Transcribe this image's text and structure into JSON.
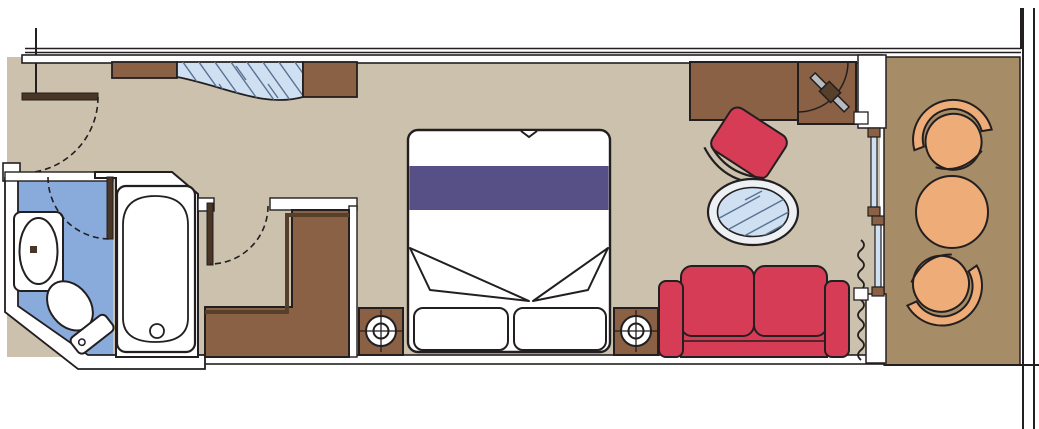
{
  "plan": {
    "scene": "cruise-ship-cabin-floor-plan",
    "areas": [
      "entry",
      "bathroom",
      "dressing-nook",
      "bedroom",
      "sitting-area",
      "balcony"
    ],
    "furniture": [
      "entry-door",
      "mirrored-closet",
      "bathroom-sink",
      "toilet",
      "bathtub",
      "bathroom-door",
      "dressing-door",
      "wardrobe",
      "nightstand-left",
      "double-bed",
      "nightstand-right",
      "desk",
      "desk-chair",
      "tv-cabinet",
      "glass-oval-table",
      "sofa",
      "curtain",
      "sliding-balcony-door",
      "balcony-armchair-top",
      "balcony-round-table",
      "balcony-armchair-bottom",
      "balcony-railing"
    ]
  },
  "colors": {
    "background": "#ffffff",
    "outline": "#231f20",
    "wall_fill": "#ffffff",
    "room_floor": "#cbc1ac",
    "balcony_floor": "#a78c68",
    "furniture_brown": "#8a6144",
    "furniture_brown_dark": "#56402c",
    "door_leaf_brown": "#4a3627",
    "accent_red": "#d63c55",
    "bed_runner_purple": "#565086",
    "bathroom_floor_blue": "#88abdc",
    "glass_blue": "#cfe0f2",
    "glass_hatch": "#5a7390",
    "upholstery_orange": "#eeac79",
    "tv_screen_gray": "#b9bcbe",
    "table_rim": "#eef1f4"
  }
}
